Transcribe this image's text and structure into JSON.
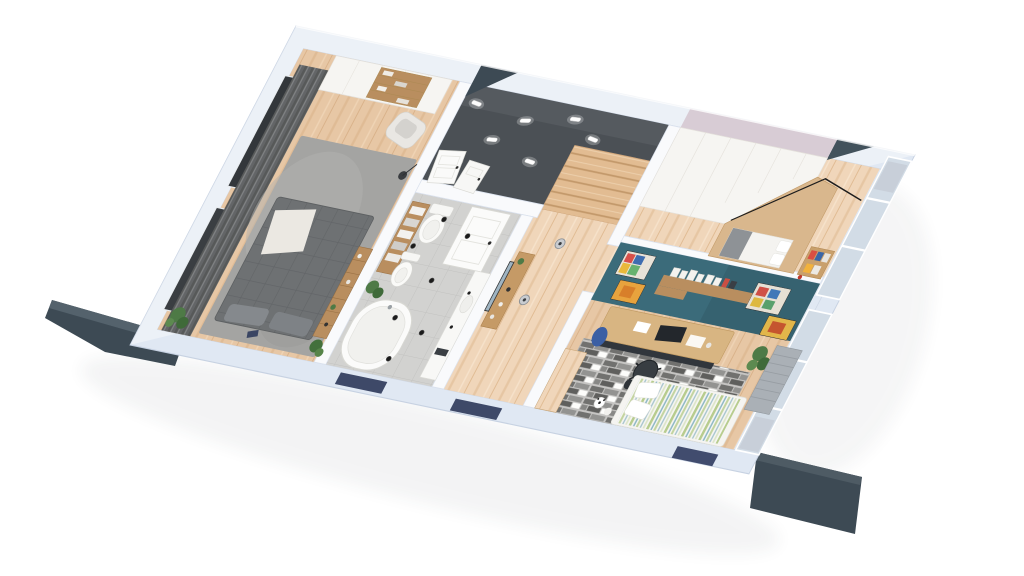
{
  "palette": {
    "background": "#ffffff",
    "outer_wall_light": "#f0f4fb",
    "outer_wall_dark": "#e0e8f3",
    "inner_wall": "#f9fafc",
    "exterior_dark": "#3d4a54",
    "exterior_dark_edge": "#57656f",
    "charcoal_floor": "#4b5055",
    "wood_floor": "#e7c7a5",
    "wood_floor_light": "#f0d6ba",
    "tile_floor": "#d2d2d0",
    "teal_wall": "#3b6b7a",
    "lavender_band": "#d8ccd5",
    "wardrobe_white": "#f6f5f2",
    "window_navy": "#3e4968",
    "glazing": "#d2dce6",
    "master_rug": "#a4a4a2",
    "master_bed": "#6e7173",
    "curtain_gray": "#6a6c6e",
    "shelf_wood": "#b98e5f",
    "desk_wood": "#d8b582",
    "alcove_wood": "#d9b78d",
    "chair_dark": "#383d42",
    "rug_brick_dark": "#5f5f5d",
    "rug_brick_light": "#939391",
    "bed_stripe_green": "#b7cc8e",
    "bed_stripe_blue": "#8fb9c6",
    "plant_green": "#4e7a46",
    "fixture_white": "#fafaf8",
    "radiator_gray": "#aab0b6",
    "light_fixture": "#fdfdfd",
    "spot_black": "#1b1b1b"
  },
  "scene": {
    "type": "3d-floor-plan-render",
    "view": "tilted-birdseye",
    "rooms": [
      {
        "name": "master-bedroom",
        "floor": "wood",
        "features": [
          "curtained-windows",
          "white-wardrobe-bookshelf",
          "gray-area-rug",
          "quilted-double-bed",
          "white-throw-blanket",
          "armchair",
          "ladder-shelf",
          "floor-lamp",
          "plants"
        ]
      },
      {
        "name": "entry-hall",
        "floor": "dark-charcoal",
        "features": [
          "ceiling-light-bars",
          "white-panel-doors",
          "staircase"
        ]
      },
      {
        "name": "bathroom",
        "floor": "gray-tile",
        "features": [
          "panel-door",
          "toilet",
          "bidet",
          "freestanding-bathtub",
          "towel-shelf",
          "vanity-counter",
          "ceiling-spots",
          "plant"
        ]
      },
      {
        "name": "hallway",
        "floor": "light-wood",
        "features": [
          "console-table",
          "mirror",
          "pendant-lights"
        ]
      },
      {
        "name": "bedroom-2",
        "features": [
          "lavender-top-band",
          "white-wardrobe",
          "wood-bed-alcove",
          "white-bedding",
          "black-rail",
          "bookshelf",
          "windows"
        ]
      },
      {
        "name": "kids-room",
        "features": [
          "teal-accent-wall",
          "posters",
          "wall-shelf-with-books",
          "wood-desk",
          "office-chair",
          "blue-backpack",
          "brick-pattern-rug",
          "striped-bed",
          "soccer-ball",
          "plant",
          "window-bench",
          "wood-closet"
        ]
      }
    ],
    "exterior": [
      "white-outer-walls",
      "dark-roof-wedges",
      "navy-window-strips",
      "side-window-glazing",
      "soft-ground-shadow"
    ]
  }
}
